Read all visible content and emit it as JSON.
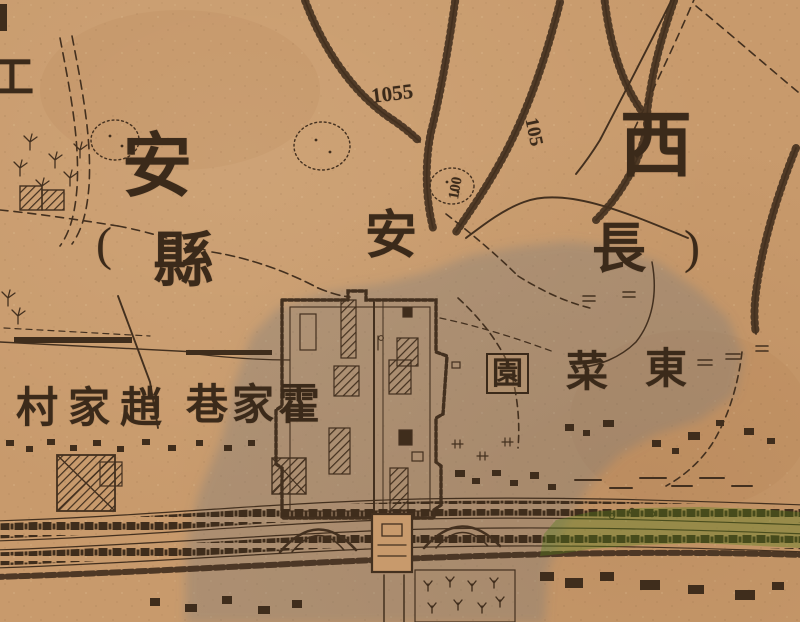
{
  "map": {
    "region_labels": {
      "xi": "西",
      "an_large": "安",
      "an_small": "安",
      "paren_open": "(",
      "chang": "長",
      "xian": "縣",
      "paren_close": ")"
    },
    "place_labels": {
      "zhao_jia_cun_display": "村家趙",
      "huo_jia_xiang_display": "巷家霍",
      "dong": "東",
      "cai": "菜",
      "yuan": "園",
      "edge_partial": "工"
    },
    "contour_labels": {
      "main": "1055",
      "right": "105",
      "center": "100"
    },
    "colors": {
      "paper": "#c89a6c",
      "ink": "#3f2d1c",
      "grey_wash": "#6e787d",
      "green_wash": "#557d1e"
    }
  }
}
